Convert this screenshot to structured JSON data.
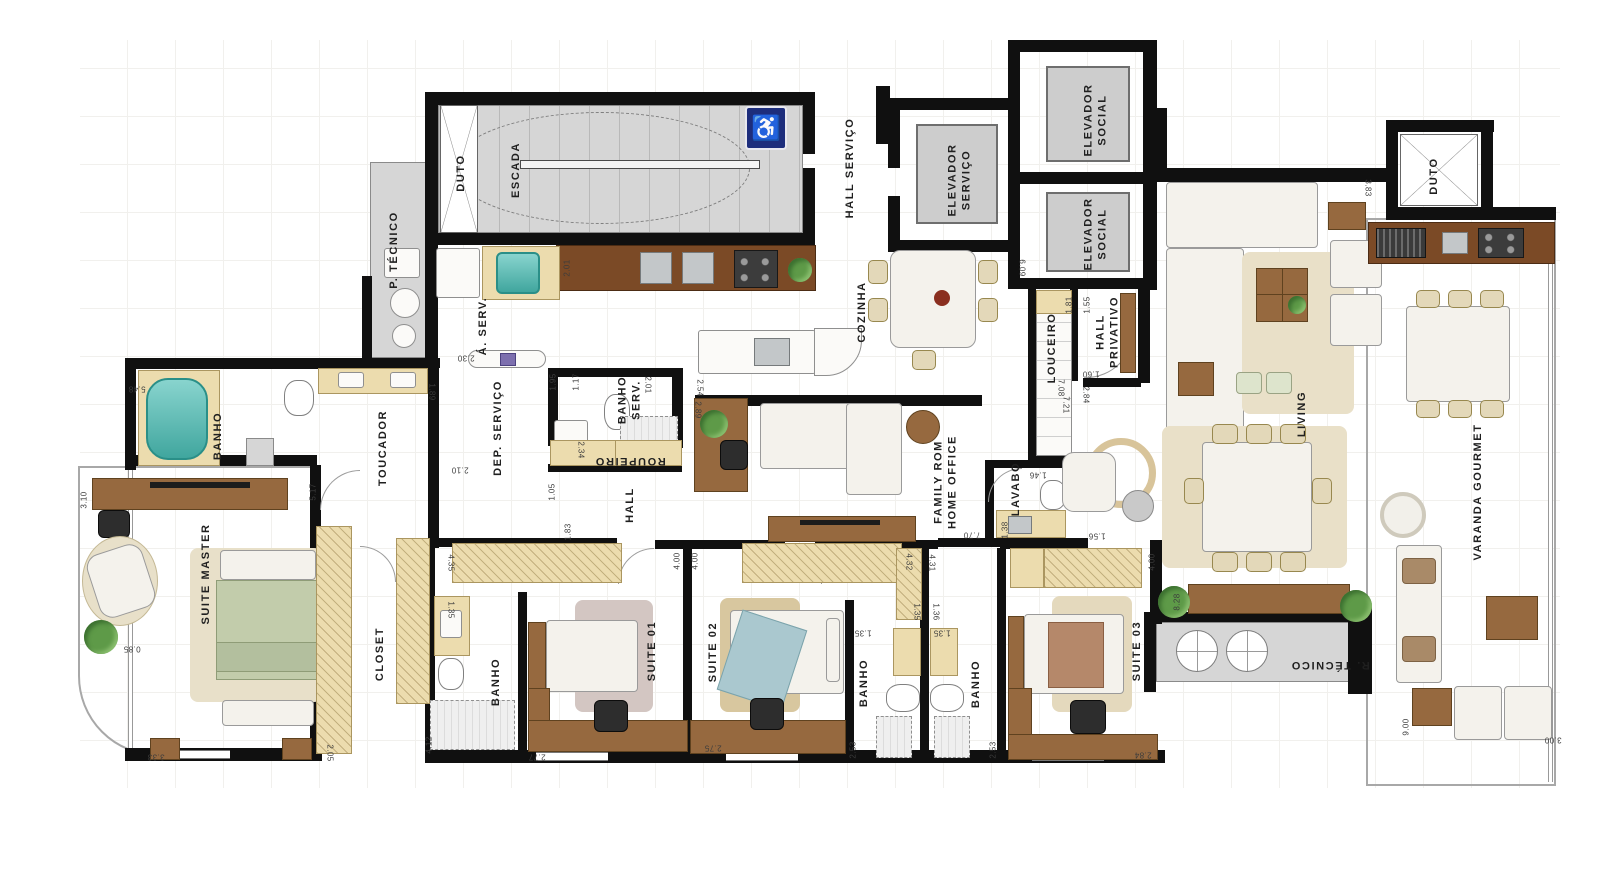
{
  "plan": {
    "colors": {
      "wall": "#101010",
      "stair_floor": "#d6d6d6",
      "wood": "#96693f",
      "counter_wood": "#7b4a26",
      "cabinet_beige": "#ecdcae",
      "bathtub_teal": "#49bdb4",
      "bed_master_green": "#c2ccab",
      "bed_suite02_blue": "#aac8cf",
      "bed_suite03_brown": "#b5886a",
      "accessibility_blue": "#1d2d7c",
      "plant_green": "#5e9a48"
    },
    "icons": {
      "accessibility": "♿"
    },
    "rooms": [
      {
        "label": "ESCADA",
        "x": 516,
        "y": 170,
        "rot": -90
      },
      {
        "label": "DUTO",
        "x": 461,
        "y": 173,
        "rot": -90
      },
      {
        "label": "P. TÉCNICO",
        "x": 394,
        "y": 250,
        "rot": -90
      },
      {
        "label": "HALL SERVIÇO",
        "x": 850,
        "y": 168,
        "rot": -90
      },
      {
        "label": "ELEVADOR\nSERVIÇO",
        "x": 960,
        "y": 180,
        "rot": -90
      },
      {
        "label": "ELEVADOR\nSOCIAL",
        "x": 1096,
        "y": 120,
        "rot": -90
      },
      {
        "label": "ELEVADOR\nSOCIAL",
        "x": 1096,
        "y": 234,
        "rot": -90
      },
      {
        "label": "COZINHA",
        "x": 862,
        "y": 312,
        "rot": -90
      },
      {
        "label": "LOUCEIRO",
        "x": 1052,
        "y": 348,
        "rot": -90
      },
      {
        "label": "HALL\nPRIVATIVO",
        "x": 1108,
        "y": 332,
        "rot": -90
      },
      {
        "label": "LIVING",
        "x": 1302,
        "y": 414,
        "rot": -90
      },
      {
        "label": "DUTO",
        "x": 1434,
        "y": 176,
        "rot": -90
      },
      {
        "label": "VARANDA GOURMET",
        "x": 1478,
        "y": 492,
        "rot": -90
      },
      {
        "label": "Á. SERV.",
        "x": 483,
        "y": 326,
        "rot": -90
      },
      {
        "label": "DEP. SERVIÇO",
        "x": 498,
        "y": 428,
        "rot": -90
      },
      {
        "label": "BANHO\nSERV.",
        "x": 630,
        "y": 400,
        "rot": -90
      },
      {
        "label": "ROUPEIRO",
        "x": 630,
        "y": 461,
        "rot": 180
      },
      {
        "label": "HALL",
        "x": 630,
        "y": 505,
        "rot": -90
      },
      {
        "label": "FAMILY ROM\nHOME OFFICE",
        "x": 946,
        "y": 482,
        "rot": -90
      },
      {
        "label": "LAVABO",
        "x": 1016,
        "y": 489,
        "rot": -90
      },
      {
        "label": "BANHO",
        "x": 218,
        "y": 436,
        "rot": -90
      },
      {
        "label": "TOUCADOR",
        "x": 383,
        "y": 448,
        "rot": -90
      },
      {
        "label": "SUITE MASTER",
        "x": 206,
        "y": 574,
        "rot": -90
      },
      {
        "label": "CLOSET",
        "x": 380,
        "y": 654,
        "rot": -90
      },
      {
        "label": "BANHO",
        "x": 496,
        "y": 682,
        "rot": -90
      },
      {
        "label": "SUITE 01",
        "x": 652,
        "y": 651,
        "rot": -90
      },
      {
        "label": "SUITE 02",
        "x": 713,
        "y": 652,
        "rot": -90
      },
      {
        "label": "BANHO",
        "x": 864,
        "y": 683,
        "rot": -90
      },
      {
        "label": "BANHO",
        "x": 976,
        "y": 684,
        "rot": -90
      },
      {
        "label": "SUITE 03",
        "x": 1137,
        "y": 651,
        "rot": -90
      },
      {
        "label": "R. TÉCNICO",
        "x": 1330,
        "y": 665,
        "rot": 180
      }
    ],
    "dimensions": [
      {
        "v": "2.01",
        "x": 567,
        "y": 268,
        "rot": -90
      },
      {
        "v": "2.30",
        "x": 466,
        "y": 358,
        "rot": 180
      },
      {
        "v": "1.95",
        "x": 553,
        "y": 382,
        "rot": -90
      },
      {
        "v": "1.17",
        "x": 576,
        "y": 382,
        "rot": -90
      },
      {
        "v": "2.01",
        "x": 648,
        "y": 385,
        "rot": 90
      },
      {
        "v": "2.54",
        "x": 700,
        "y": 388,
        "rot": 90
      },
      {
        "v": "2.89",
        "x": 698,
        "y": 410,
        "rot": 90
      },
      {
        "v": "2.34",
        "x": 581,
        "y": 450,
        "rot": 90
      },
      {
        "v": "2.10",
        "x": 460,
        "y": 470,
        "rot": 180
      },
      {
        "v": "1.05",
        "x": 552,
        "y": 492,
        "rot": -90
      },
      {
        "v": "1.83",
        "x": 568,
        "y": 532,
        "rot": -90
      },
      {
        "v": "5.48",
        "x": 137,
        "y": 389,
        "rot": 180
      },
      {
        "v": "1.89",
        "x": 432,
        "y": 392,
        "rot": 90
      },
      {
        "v": "5.17",
        "x": 313,
        "y": 492,
        "rot": -90
      },
      {
        "v": "3.10",
        "x": 84,
        "y": 500,
        "rot": -90
      },
      {
        "v": "0.85",
        "x": 132,
        "y": 649,
        "rot": 180
      },
      {
        "v": "3.33",
        "x": 156,
        "y": 757,
        "rot": 180
      },
      {
        "v": "2.05",
        "x": 330,
        "y": 753,
        "rot": 90
      },
      {
        "v": "4.12",
        "x": 429,
        "y": 745,
        "rot": -90
      },
      {
        "v": "4.35",
        "x": 451,
        "y": 563,
        "rot": 90
      },
      {
        "v": "1.35",
        "x": 451,
        "y": 610,
        "rot": 90
      },
      {
        "v": "2.77",
        "x": 537,
        "y": 757,
        "rot": 180
      },
      {
        "v": "4.00",
        "x": 677,
        "y": 561,
        "rot": -90
      },
      {
        "v": "4.00",
        "x": 695,
        "y": 561,
        "rot": -90
      },
      {
        "v": "4.32",
        "x": 909,
        "y": 562,
        "rot": 90
      },
      {
        "v": "4.31",
        "x": 932,
        "y": 563,
        "rot": 90
      },
      {
        "v": "1.35",
        "x": 917,
        "y": 612,
        "rot": 90
      },
      {
        "v": "1.36",
        "x": 936,
        "y": 612,
        "rot": 90
      },
      {
        "v": "1.35",
        "x": 863,
        "y": 633,
        "rot": 180
      },
      {
        "v": "1.35",
        "x": 942,
        "y": 633,
        "rot": 180
      },
      {
        "v": "2.75",
        "x": 713,
        "y": 748,
        "rot": 180
      },
      {
        "v": "2.53",
        "x": 853,
        "y": 750,
        "rot": -90
      },
      {
        "v": "2.53",
        "x": 993,
        "y": 750,
        "rot": -90
      },
      {
        "v": "2.84",
        "x": 1143,
        "y": 755,
        "rot": 180
      },
      {
        "v": "4.00",
        "x": 1152,
        "y": 562,
        "rot": -90
      },
      {
        "v": "6.09",
        "x": 1022,
        "y": 268,
        "rot": 90
      },
      {
        "v": "1.81",
        "x": 1069,
        "y": 305,
        "rot": -90
      },
      {
        "v": "1.55",
        "x": 1087,
        "y": 305,
        "rot": -90
      },
      {
        "v": "1.60",
        "x": 1091,
        "y": 374,
        "rot": 180
      },
      {
        "v": "7.08",
        "x": 1061,
        "y": 388,
        "rot": 90
      },
      {
        "v": "7.21",
        "x": 1066,
        "y": 405,
        "rot": 90
      },
      {
        "v": "2.84",
        "x": 1086,
        "y": 395,
        "rot": 90
      },
      {
        "v": "3.83",
        "x": 1368,
        "y": 188,
        "rot": 90
      },
      {
        "v": "1.46",
        "x": 1038,
        "y": 475,
        "rot": 180
      },
      {
        "v": "1.38",
        "x": 1005,
        "y": 530,
        "rot": -90
      },
      {
        "v": "1.56",
        "x": 1097,
        "y": 536,
        "rot": 180
      },
      {
        "v": "7.70",
        "x": 972,
        "y": 535,
        "rot": 180
      },
      {
        "v": "8.28",
        "x": 1177,
        "y": 602,
        "rot": -90
      },
      {
        "v": "9.00",
        "x": 1406,
        "y": 727,
        "rot": -90
      },
      {
        "v": "3.00",
        "x": 1553,
        "y": 740,
        "rot": 180
      }
    ]
  }
}
